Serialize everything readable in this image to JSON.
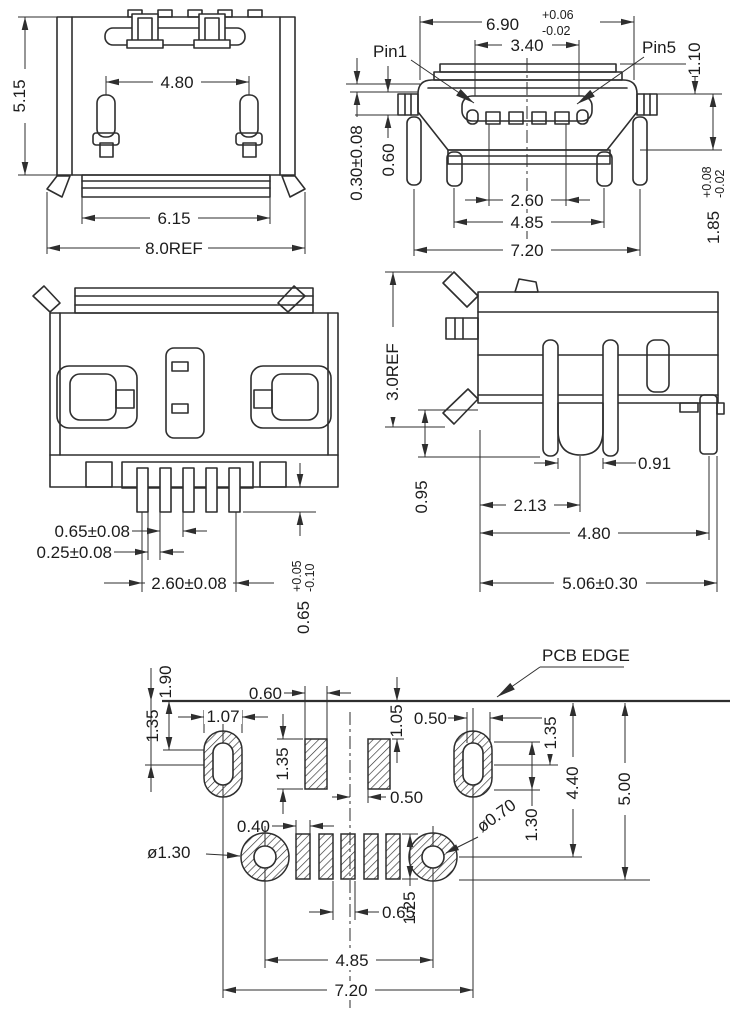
{
  "meta": {
    "line_color": "#2e2e2e",
    "background": "#ffffff",
    "drawing_type": "micro-usb-connector-dimensioned-drawing"
  },
  "rear_view": {
    "height": "5.15",
    "post_spacing": "4.80",
    "flange_width": "6.15",
    "overall_width": "8.0REF"
  },
  "front_view": {
    "pin1_label": "Pin1",
    "pin5_label": "Pin5",
    "shell_width": "6.90",
    "shell_width_plus": "+0.06",
    "shell_width_minus": "-0.02",
    "tongue_width": "3.40",
    "top_height": "1.10",
    "lead_thickness": "0.30±0.08",
    "lead_standoff": "0.60",
    "contact_span": "2.60",
    "inner_leg_span": "4.85",
    "outer_leg_span": "7.20",
    "mount_height": "1.85",
    "mount_height_plus": "+0.08",
    "mount_height_minus": "-0.02"
  },
  "bottom_view": {
    "pin_pitch": "0.65±0.08",
    "pin_gap": "0.25±0.08",
    "pin_row_span": "2.60±0.08",
    "pin_protrusion": "0.65",
    "pin_protrusion_plus": "+0.05",
    "pin_protrusion_minus": "-0.10"
  },
  "side_view": {
    "overall_height": "3.0REF",
    "leg_drop": "0.95",
    "slot_offset": "2.13",
    "leg_gap": "0.91",
    "depth": "4.80",
    "overall_depth": "5.06±0.30"
  },
  "pcb_layout": {
    "edge_label": "PCB EDGE",
    "edge_to_slot_center": "1.90",
    "edge_to_slot_top": "1.35",
    "slot_pad_width": "1.07",
    "pad_width": "0.60",
    "pad_height": "1.35",
    "edge_to_pad_top": "1.05",
    "slot_hole_width": "0.50",
    "pad_to_center": "0.50",
    "slot_pad_depth": "1.35",
    "slot_to_hole": "1.30",
    "edge_to_hole_center": "4.40",
    "edge_to_outline": "5.00",
    "small_pad_width": "0.40",
    "left_hole_dia": "ø1.30",
    "right_hole_dia": "ø0.70",
    "small_pad_pitch": "0.65",
    "small_pad_height": "1.25",
    "hole_span": "4.85",
    "slot_span": "7.20"
  }
}
